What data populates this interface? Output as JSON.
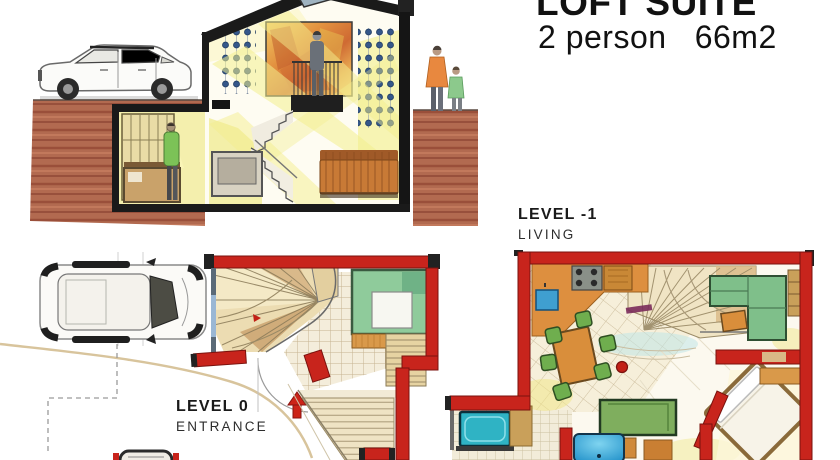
{
  "page": {
    "width": 840,
    "height": 460,
    "background": "#ffffff"
  },
  "title_block": {
    "title": "LOFT SUITE",
    "subtitle": "2 person   66m2"
  },
  "labels": {
    "level_minus_1": {
      "title": "LEVEL -1",
      "subtitle": "LIVING"
    },
    "level_0": {
      "title": "LEVEL 0",
      "subtitle": "ENTRANCE"
    }
  },
  "colors": {
    "wall_red": "#c8241c",
    "earth_brown": "#b26a50",
    "interior_yellow": "#f2eda0",
    "chair_green": "#6fae4e",
    "sofa_green": "#7fbf8a",
    "wood_orange": "#d98e3b",
    "shower_blue": "#2f9fd8",
    "bathtub_teal": "#2fb3c4",
    "ink": "#1a1a1a"
  }
}
